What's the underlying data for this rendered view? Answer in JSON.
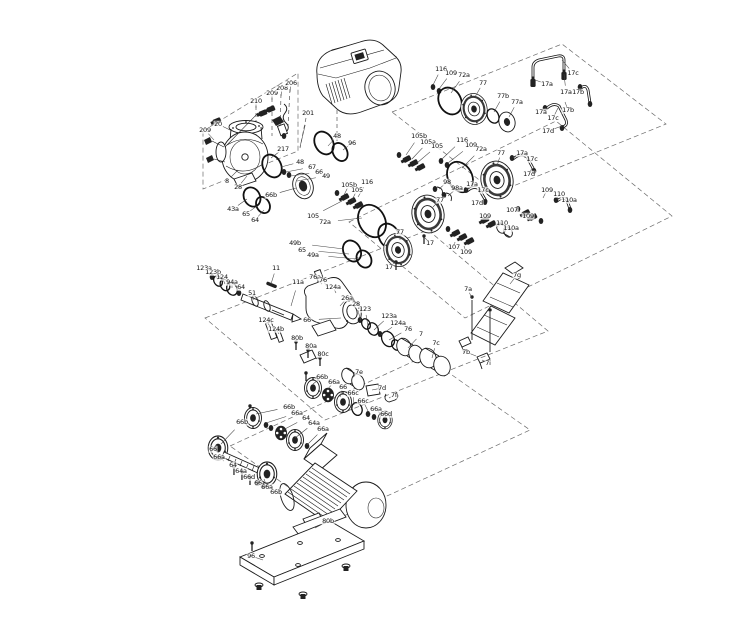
{
  "diagram": {
    "description": "Exploded parts diagram of an in-line pump with drive unit, shaft seal kits, couplings, coupling guard, motor and base plate",
    "colors": {
      "background": "#ffffff",
      "ink": "#1a1a1a",
      "frame_dash": "#6a6a6a",
      "dark_fill": "#222222"
    },
    "labels": [
      {
        "t": "209",
        "x": 205,
        "y": 130,
        "d": [
          214,
          140
        ]
      },
      {
        "t": "20",
        "x": 218,
        "y": 124,
        "d": [
          232,
          131
        ]
      },
      {
        "t": "210",
        "x": 256,
        "y": 101,
        "d": [
          256,
          108
        ]
      },
      {
        "t": "209",
        "x": 272,
        "y": 93,
        "d": [
          272,
          100
        ]
      },
      {
        "t": "208",
        "x": 282,
        "y": 88,
        "d": [
          281,
          96
        ]
      },
      {
        "t": "206",
        "x": 291,
        "y": 83,
        "d": [
          290,
          92
        ]
      },
      {
        "t": "201",
        "x": 308,
        "y": 113,
        "d": [
          300,
          147
        ]
      },
      {
        "t": "217",
        "x": 283,
        "y": 149,
        "d": [
          271,
          158
        ]
      },
      {
        "t": "8",
        "x": 227,
        "y": 181,
        "d": [
          238,
          170
        ]
      },
      {
        "t": "28",
        "x": 238,
        "y": 187,
        "d": [
          247,
          176
        ]
      },
      {
        "t": "43a",
        "x": 233,
        "y": 209,
        "d": [
          247,
          199
        ]
      },
      {
        "t": "65",
        "x": 246,
        "y": 214,
        "d": [
          257,
          206
        ]
      },
      {
        "t": "64",
        "x": 255,
        "y": 220,
        "d": [
          264,
          210
        ]
      },
      {
        "t": "48",
        "x": 300,
        "y": 162,
        "d": [
          281,
          167
        ]
      },
      {
        "t": "67",
        "x": 312,
        "y": 167,
        "d": [
          286,
          172
        ]
      },
      {
        "t": "66",
        "x": 319,
        "y": 172,
        "d": [
          291,
          176
        ]
      },
      {
        "t": "49",
        "x": 326,
        "y": 176,
        "d": [
          297,
          181
        ]
      },
      {
        "t": "66b",
        "x": 271,
        "y": 195,
        "d": [
          296,
          188
        ]
      },
      {
        "t": "48",
        "x": 337,
        "y": 136,
        "d": [
          328,
          146
        ]
      },
      {
        "t": "96",
        "x": 352,
        "y": 143,
        "d": [
          343,
          150
        ]
      },
      {
        "t": "105",
        "x": 313,
        "y": 216,
        "d": [
          342,
          201
        ]
      },
      {
        "t": "72a",
        "x": 325,
        "y": 222,
        "d": [
          362,
          218
        ]
      },
      {
        "t": "49b",
        "x": 295,
        "y": 243,
        "d": [
          344,
          249
        ]
      },
      {
        "t": "65",
        "x": 302,
        "y": 250,
        "d": [
          349,
          254
        ]
      },
      {
        "t": "49a",
        "x": 313,
        "y": 255,
        "d": [
          357,
          259
        ]
      },
      {
        "t": "105b",
        "x": 349,
        "y": 185,
        "d": [
          344,
          195
        ]
      },
      {
        "t": "105",
        "x": 357,
        "y": 190,
        "d": [
          352,
          200
        ]
      },
      {
        "t": "116",
        "x": 367,
        "y": 182,
        "d": [
          358,
          197
        ]
      },
      {
        "t": "105b",
        "x": 419,
        "y": 136,
        "d": [
          406,
          155
        ]
      },
      {
        "t": "105a",
        "x": 428,
        "y": 142,
        "d": [
          412,
          159
        ]
      },
      {
        "t": "105",
        "x": 437,
        "y": 146,
        "d": [
          417,
          163
        ]
      },
      {
        "t": "116",
        "x": 462,
        "y": 140,
        "d": [
          442,
          159
        ]
      },
      {
        "t": "109",
        "x": 471,
        "y": 145,
        "d": [
          448,
          163
        ]
      },
      {
        "t": "72a",
        "x": 481,
        "y": 149,
        "d": [
          462,
          168
        ]
      },
      {
        "t": "77",
        "x": 501,
        "y": 153,
        "d": [
          497,
          166
        ]
      },
      {
        "t": "116",
        "x": 441,
        "y": 69,
        "d": [
          433,
          85
        ]
      },
      {
        "t": "109",
        "x": 451,
        "y": 73,
        "d": [
          439,
          89
        ]
      },
      {
        "t": "72a",
        "x": 464,
        "y": 75,
        "d": [
          451,
          93
        ]
      },
      {
        "t": "77",
        "x": 483,
        "y": 83,
        "d": [
          475,
          97
        ]
      },
      {
        "t": "77b",
        "x": 503,
        "y": 96,
        "d": [
          494,
          112
        ]
      },
      {
        "t": "77a",
        "x": 517,
        "y": 102,
        "d": [
          509,
          117
        ]
      },
      {
        "t": "17a",
        "x": 547,
        "y": 84,
        "d": [
          535,
          80
        ]
      },
      {
        "t": "17c",
        "x": 573,
        "y": 73,
        "d": [
          562,
          60
        ]
      },
      {
        "t": "17b",
        "x": 578,
        "y": 92,
        "d": [
          583,
          89
        ]
      },
      {
        "t": "17a",
        "x": 566,
        "y": 92,
        "d": [
          564,
          74
        ]
      },
      {
        "t": "17b",
        "x": 568,
        "y": 110,
        "d": [
          565,
          102
        ]
      },
      {
        "t": "17a",
        "x": 541,
        "y": 112,
        "d": [
          546,
          108
        ]
      },
      {
        "t": "17c",
        "x": 553,
        "y": 118,
        "d": [
          558,
          108
        ]
      },
      {
        "t": "17d",
        "x": 548,
        "y": 131,
        "d": [
          562,
          126
        ]
      },
      {
        "t": "17a",
        "x": 522,
        "y": 153,
        "d": [
          513,
          158
        ]
      },
      {
        "t": "17c",
        "x": 532,
        "y": 159,
        "d": [
          524,
          157
        ]
      },
      {
        "t": "17d",
        "x": 529,
        "y": 174,
        "d": [
          532,
          168
        ]
      },
      {
        "t": "17a",
        "x": 472,
        "y": 184,
        "d": [
          466,
          190
        ]
      },
      {
        "t": "17c",
        "x": 483,
        "y": 190,
        "d": [
          477,
          189
        ]
      },
      {
        "t": "17d",
        "x": 477,
        "y": 203,
        "d": [
          483,
          200
        ]
      },
      {
        "t": "98",
        "x": 447,
        "y": 182,
        "d": [
          439,
          189
        ]
      },
      {
        "t": "98a",
        "x": 457,
        "y": 188,
        "d": [
          448,
          196
        ]
      },
      {
        "t": "77",
        "x": 440,
        "y": 200,
        "d": [
          433,
          207
        ]
      },
      {
        "t": "17",
        "x": 430,
        "y": 243,
        "d": [
          425,
          238
        ]
      },
      {
        "t": "77",
        "x": 400,
        "y": 232,
        "d": [
          400,
          240
        ]
      },
      {
        "t": "17",
        "x": 389,
        "y": 267,
        "d": [
          396,
          262
        ]
      },
      {
        "t": "107",
        "x": 454,
        "y": 247,
        "d": [
          455,
          242
        ]
      },
      {
        "t": "109",
        "x": 466,
        "y": 252,
        "d": [
          464,
          246
        ]
      },
      {
        "t": "109",
        "x": 485,
        "y": 216,
        "d": [
          487,
          220
        ]
      },
      {
        "t": "110",
        "x": 502,
        "y": 223,
        "d": [
          497,
          227
        ]
      },
      {
        "t": "110a",
        "x": 511,
        "y": 228,
        "d": [
          504,
          230
        ]
      },
      {
        "t": "107",
        "x": 512,
        "y": 210,
        "d": [
          520,
          211
        ]
      },
      {
        "t": "109",
        "x": 528,
        "y": 216,
        "d": [
          528,
          213
        ]
      },
      {
        "t": "109",
        "x": 547,
        "y": 190,
        "d": [
          543,
          198
        ]
      },
      {
        "t": "110",
        "x": 559,
        "y": 194,
        "d": [
          557,
          200
        ]
      },
      {
        "t": "110a",
        "x": 569,
        "y": 200,
        "d": [
          566,
          204
        ]
      },
      {
        "t": "123a",
        "x": 204,
        "y": 268,
        "d": [
          211,
          276
        ]
      },
      {
        "t": "123b",
        "x": 213,
        "y": 272,
        "d": [
          218,
          280
        ]
      },
      {
        "t": "124",
        "x": 222,
        "y": 277,
        "d": [
          225,
          284
        ]
      },
      {
        "t": "94a",
        "x": 232,
        "y": 282,
        "d": [
          232,
          288
        ]
      },
      {
        "t": "64",
        "x": 241,
        "y": 287,
        "d": [
          239,
          292
        ]
      },
      {
        "t": "51",
        "x": 252,
        "y": 293,
        "d": [
          254,
          300
        ]
      },
      {
        "t": "11",
        "x": 276,
        "y": 268,
        "d": [
          271,
          284
        ]
      },
      {
        "t": "11a",
        "x": 298,
        "y": 282,
        "d": [
          291,
          306
        ]
      },
      {
        "t": "76a",
        "x": 315,
        "y": 277,
        "d": [
          322,
          284
        ]
      },
      {
        "t": "76",
        "x": 323,
        "y": 280,
        "d": [
          327,
          287
        ]
      },
      {
        "t": "124a",
        "x": 333,
        "y": 287,
        "d": [
          336,
          293
        ]
      },
      {
        "t": "26a",
        "x": 347,
        "y": 298,
        "d": [
          340,
          306
        ]
      },
      {
        "t": "28",
        "x": 356,
        "y": 304,
        "d": [
          361,
          321
        ]
      },
      {
        "t": "123",
        "x": 365,
        "y": 309,
        "d": [
          368,
          326
        ]
      },
      {
        "t": "123a",
        "x": 389,
        "y": 316,
        "d": [
          374,
          330
        ]
      },
      {
        "t": "124a",
        "x": 398,
        "y": 323,
        "d": [
          381,
          335
        ]
      },
      {
        "t": "76",
        "x": 408,
        "y": 329,
        "d": [
          389,
          340
        ]
      },
      {
        "t": "7",
        "x": 421,
        "y": 334,
        "d": [
          408,
          348
        ]
      },
      {
        "t": "7c",
        "x": 436,
        "y": 343,
        "d": [
          432,
          358
        ]
      },
      {
        "t": "124c",
        "x": 266,
        "y": 320,
        "d": [
          271,
          328
        ]
      },
      {
        "t": "124b",
        "x": 276,
        "y": 329,
        "d": [
          279,
          334
        ]
      },
      {
        "t": "66",
        "x": 307,
        "y": 320,
        "d": [
          341,
          318
        ]
      },
      {
        "t": "80b",
        "x": 297,
        "y": 338,
        "d": [
          297,
          342
        ]
      },
      {
        "t": "80a",
        "x": 311,
        "y": 346,
        "d": [
          308,
          351
        ]
      },
      {
        "t": "80c",
        "x": 323,
        "y": 354,
        "d": [
          316,
          359
        ]
      },
      {
        "t": "7e",
        "x": 359,
        "y": 372,
        "d": [
          352,
          378
        ]
      },
      {
        "t": "7d",
        "x": 382,
        "y": 388,
        "d": [
          372,
          390
        ]
      },
      {
        "t": "7f",
        "x": 394,
        "y": 395,
        "d": [
          389,
          398
        ]
      },
      {
        "t": "7g",
        "x": 517,
        "y": 275,
        "d": [
          510,
          284
        ]
      },
      {
        "t": "7a",
        "x": 468,
        "y": 289,
        "d": [
          472,
          299
        ]
      },
      {
        "t": "7b",
        "x": 466,
        "y": 352,
        "d": [
          476,
          356
        ]
      },
      {
        "t": "7i",
        "x": 488,
        "y": 363,
        "d": [
          482,
          360
        ]
      },
      {
        "t": "66b",
        "x": 322,
        "y": 377,
        "d": [
          313,
          384
        ]
      },
      {
        "t": "66a",
        "x": 334,
        "y": 382,
        "d": [
          326,
          391
        ]
      },
      {
        "t": "66",
        "x": 343,
        "y": 387,
        "d": [
          340,
          397
        ]
      },
      {
        "t": "66c",
        "x": 353,
        "y": 393,
        "d": [
          354,
          405
        ]
      },
      {
        "t": "66c",
        "x": 363,
        "y": 401,
        "d": [
          368,
          411
        ]
      },
      {
        "t": "66a",
        "x": 376,
        "y": 409,
        "d": [
          382,
          416
        ]
      },
      {
        "t": "66d",
        "x": 386,
        "y": 414,
        "d": [
          385,
          419
        ]
      },
      {
        "t": "66b",
        "x": 289,
        "y": 407,
        "d": [
          256,
          414
        ]
      },
      {
        "t": "66a",
        "x": 297,
        "y": 413,
        "d": [
          266,
          423
        ]
      },
      {
        "t": "64",
        "x": 306,
        "y": 418,
        "d": [
          281,
          431
        ]
      },
      {
        "t": "64a",
        "x": 314,
        "y": 423,
        "d": [
          295,
          438
        ]
      },
      {
        "t": "66a",
        "x": 323,
        "y": 429,
        "d": [
          307,
          445
        ]
      },
      {
        "t": "66b",
        "x": 242,
        "y": 422,
        "d": [
          221,
          444
        ]
      },
      {
        "t": "66",
        "x": 213,
        "y": 449,
        "d": [
          219,
          452
        ]
      },
      {
        "t": "66a",
        "x": 219,
        "y": 457,
        "d": [
          224,
          461
        ]
      },
      {
        "t": "64",
        "x": 233,
        "y": 465,
        "d": [
          234,
          469
        ]
      },
      {
        "t": "64a",
        "x": 241,
        "y": 471,
        "d": [
          242,
          475
        ]
      },
      {
        "t": "66d",
        "x": 249,
        "y": 477,
        "d": [
          250,
          481
        ]
      },
      {
        "t": "66",
        "x": 258,
        "y": 483,
        "d": [
          259,
          486
        ]
      },
      {
        "t": "66a",
        "x": 267,
        "y": 487,
        "d": [
          264,
          479
        ]
      },
      {
        "t": "66b",
        "x": 276,
        "y": 492,
        "d": [
          270,
          487
        ]
      },
      {
        "t": "80b",
        "x": 328,
        "y": 521,
        "d": [
          315,
          528
        ]
      },
      {
        "t": "96",
        "x": 251,
        "y": 556,
        "d": [
          263,
          560
        ]
      }
    ]
  }
}
